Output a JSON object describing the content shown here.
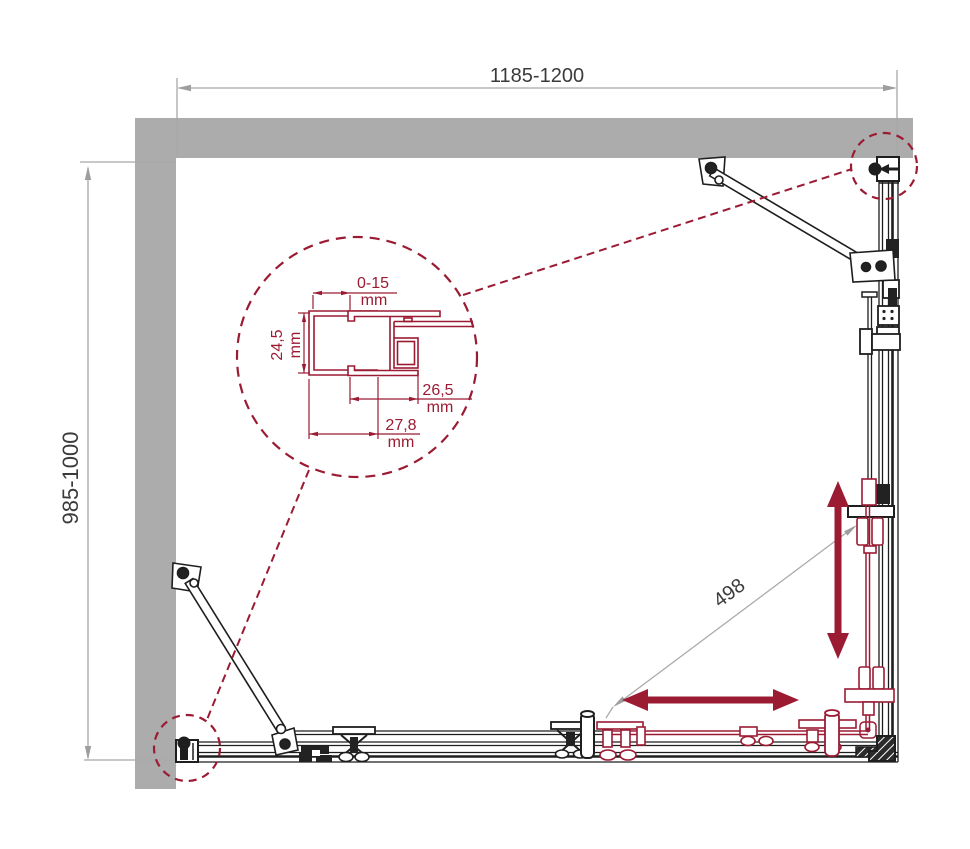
{
  "drawing": {
    "type": "shower-enclosure-plan-view",
    "dimensions": {
      "width": {
        "label": "1185-1200"
      },
      "depth": {
        "label": "985-1000"
      },
      "travel": {
        "label": "498"
      }
    },
    "detail": {
      "gap": {
        "value": "0-15",
        "unit": "mm"
      },
      "height": {
        "value": "24,5",
        "unit": "mm"
      },
      "inner": {
        "value": "26,5",
        "unit": "mm"
      },
      "outer": {
        "value": "27,8",
        "unit": "mm"
      }
    },
    "colors": {
      "accent_maroon": "#9B1B33",
      "wall_gray": "#ACACAC",
      "dimension_gray": "#A8A8A8",
      "frame_black": "#1E1E1E",
      "text": "#3b3b3b"
    }
  }
}
